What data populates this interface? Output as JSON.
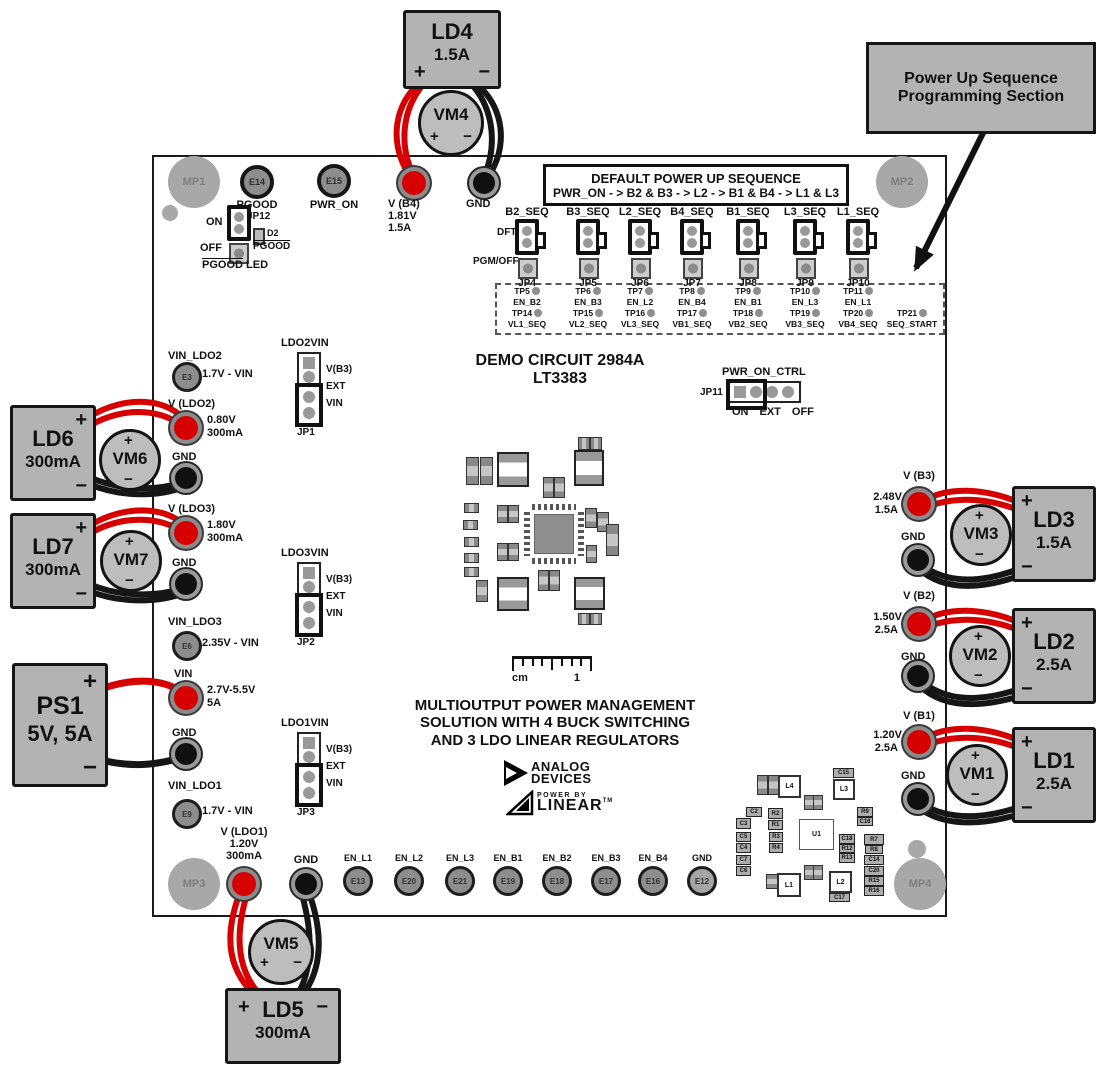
{
  "signs": {
    "plus": "+",
    "minus": "−"
  },
  "callout": {
    "line1": "Power Up Sequence",
    "line2": "Programming Section"
  },
  "board": {
    "mp1": "MP1",
    "mp2": "MP2",
    "mp3": "MP3",
    "mp4": "MP4",
    "title1": "DEMO CIRCUIT 2984A",
    "title2": "LT3383",
    "desc1": "MULTIOUTPUT POWER MANAGEMENT",
    "desc2": "SOLUTION WITH 4 BUCK SWITCHING",
    "desc3": "AND 3 LDO LINEAR REGULATORS",
    "ruler_unit": "cm",
    "ruler_mark": "1",
    "logo1": "ANALOG",
    "logo2": "DEVICES",
    "logo3": "POWER BY",
    "logo4": "LINEAR",
    "logo_tm": "TM",
    "e14": {
      "id": "E14",
      "label": "PGOOD"
    },
    "e15": {
      "id": "E15",
      "label": "PWR_ON"
    },
    "jp12": {
      "on": "ON",
      "off": "OFF",
      "id": "JP12",
      "d2": "D2",
      "d2_label": "PGOOD",
      "led_pgood": "PGOOD",
      "led_led": " LED"
    }
  },
  "top": {
    "ld4": {
      "name": "LD4",
      "rating": "1.5A"
    },
    "vm4": "VM4",
    "vb4": {
      "label": "V (B4)",
      "value": "1.81V",
      "current": "1.5A"
    },
    "gnd": "GND"
  },
  "seq": {
    "header1": "DEFAULT POWER UP SEQUENCE",
    "header2": "PWR_ON - > B2 & B3 - > L2 - > B1 & B4 - > L1 & L3",
    "dft": "DFT",
    "pgm": "PGM/OFF",
    "jumpers": [
      {
        "signal": "B2_SEQ",
        "jp": "JP4"
      },
      {
        "signal": "B3_SEQ",
        "jp": "JP5"
      },
      {
        "signal": "L2_SEQ",
        "jp": "JP6"
      },
      {
        "signal": "B4_SEQ",
        "jp": "JP7"
      },
      {
        "signal": "B1_SEQ",
        "jp": "JP8"
      },
      {
        "signal": "L3_SEQ",
        "jp": "JP9"
      },
      {
        "signal": "L1_SEQ",
        "jp": "JP10"
      }
    ],
    "tp1": [
      {
        "tp": "TP5",
        "sig": "EN_B2"
      },
      {
        "tp": "TP6",
        "sig": "EN_B3"
      },
      {
        "tp": "TP7",
        "sig": "EN_L2"
      },
      {
        "tp": "TP8",
        "sig": "EN_B4"
      },
      {
        "tp": "TP9",
        "sig": "EN_B1"
      },
      {
        "tp": "TP10",
        "sig": "EN_L3"
      },
      {
        "tp": "TP11",
        "sig": "EN_L1"
      }
    ],
    "tp2": [
      {
        "tp": "TP14",
        "sig": "VL1_SEQ"
      },
      {
        "tp": "TP15",
        "sig": "VL2_SEQ"
      },
      {
        "tp": "TP16",
        "sig": "VL3_SEQ"
      },
      {
        "tp": "TP17",
        "sig": "VB1_SEQ"
      },
      {
        "tp": "TP18",
        "sig": "VB2_SEQ"
      },
      {
        "tp": "TP19",
        "sig": "VB3_SEQ"
      },
      {
        "tp": "TP20",
        "sig": "VB4_SEQ"
      },
      {
        "tp": "TP21",
        "sig": "SEQ_START"
      }
    ]
  },
  "pwrctrl": {
    "label": "PWR_ON_CTRL",
    "jp": "JP11",
    "on": "ON",
    "ext": "EXT",
    "off": "OFF"
  },
  "ldojp": [
    {
      "name": "LDO2VIN",
      "jp": "JP1",
      "p1": "V(B3)",
      "p2": "EXT",
      "p3": "VIN"
    },
    {
      "name": "LDO3VIN",
      "jp": "JP2",
      "p1": "V(B3)",
      "p2": "EXT",
      "p3": "VIN"
    },
    {
      "name": "LDO1VIN",
      "jp": "JP3",
      "p1": "V(B3)",
      "p2": "EXT",
      "p3": "VIN"
    }
  ],
  "left": {
    "vin_ldo2": {
      "name": "VIN_LDO2",
      "pad": "E3",
      "note": "1.7V - VIN"
    },
    "vldo2": {
      "name": "V (LDO2)",
      "value": "0.80V",
      "current": "300mA"
    },
    "gnd1": "GND",
    "vldo3": {
      "name": "V (LDO3)",
      "value": "1.80V",
      "current": "300mA"
    },
    "gnd2": "GND",
    "vin_ldo3": {
      "name": "VIN_LDO3",
      "pad": "E6",
      "note": "2.35V - VIN"
    },
    "vin": {
      "name": "VIN",
      "value": "2.7V-5.5V",
      "current": "5A"
    },
    "gnd3": "GND",
    "vin_ldo1": {
      "name": "VIN_LDO1",
      "pad": "E9",
      "note": "1.7V - VIN"
    },
    "ld6": {
      "name": "LD6",
      "rating": "300mA"
    },
    "vm6": "VM6",
    "ld7": {
      "name": "LD7",
      "rating": "300mA"
    },
    "vm7": "VM7",
    "ps1": {
      "name": "PS1",
      "rating": "5V, 5A"
    }
  },
  "right": {
    "vb3": {
      "name": "V (B3)",
      "value": "2.48V",
      "current": "1.5A"
    },
    "gnd1": "GND",
    "vm3": "VM3",
    "ld3": {
      "name": "LD3",
      "rating": "1.5A"
    },
    "vb2": {
      "name": "V (B2)",
      "value": "1.50V",
      "current": "2.5A"
    },
    "gnd2": "GND",
    "vm2": "VM2",
    "ld2": {
      "name": "LD2",
      "rating": "2.5A"
    },
    "vb1": {
      "name": "V (B1)",
      "value": "1.20V",
      "current": "2.5A"
    },
    "gnd3": "GND",
    "vm1": "VM1",
    "ld1": {
      "name": "LD1",
      "rating": "2.5A"
    }
  },
  "bottom": {
    "vldo1": {
      "name": "V (LDO1)",
      "value": "1.20V",
      "current": "300mA"
    },
    "gnd_l": "GND",
    "enables": [
      {
        "sig": "EN_L1",
        "pad": "E13"
      },
      {
        "sig": "EN_L2",
        "pad": "E20"
      },
      {
        "sig": "EN_L3",
        "pad": "E21"
      },
      {
        "sig": "EN_B1",
        "pad": "E19"
      },
      {
        "sig": "EN_B2",
        "pad": "E18"
      },
      {
        "sig": "EN_B3",
        "pad": "E17"
      },
      {
        "sig": "EN_B4",
        "pad": "E16"
      }
    ],
    "gnd_r": {
      "sig": "GND",
      "pad": "E12"
    },
    "vm5": "VM5",
    "ld5": {
      "name": "LD5",
      "rating": "300mA"
    }
  },
  "silk": {
    "parts": [
      {
        "l": "L4"
      },
      {
        "l": "C15"
      },
      {
        "l": "L3"
      },
      {
        "l": "U1"
      },
      {
        "l": "L1"
      },
      {
        "l": "L2"
      },
      {
        "l": "C17"
      },
      {
        "l": "C2"
      },
      {
        "l": "R2"
      },
      {
        "l": "C3"
      },
      {
        "l": "R1"
      },
      {
        "l": "C5"
      },
      {
        "l": "R3"
      },
      {
        "l": "C4"
      },
      {
        "l": "R4"
      },
      {
        "l": "C7"
      },
      {
        "l": "C6"
      },
      {
        "l": "R9"
      },
      {
        "l": "C16"
      },
      {
        "l": "C18"
      },
      {
        "l": "R12"
      },
      {
        "l": "R13"
      },
      {
        "l": "R7"
      },
      {
        "l": "R8"
      },
      {
        "l": "C14"
      },
      {
        "l": "C20"
      },
      {
        "l": "R15"
      },
      {
        "l": "R16"
      }
    ]
  },
  "colors": {
    "wire_red": "#d60000",
    "wire_black": "#161616",
    "box_gray": "#b3b3b3"
  }
}
